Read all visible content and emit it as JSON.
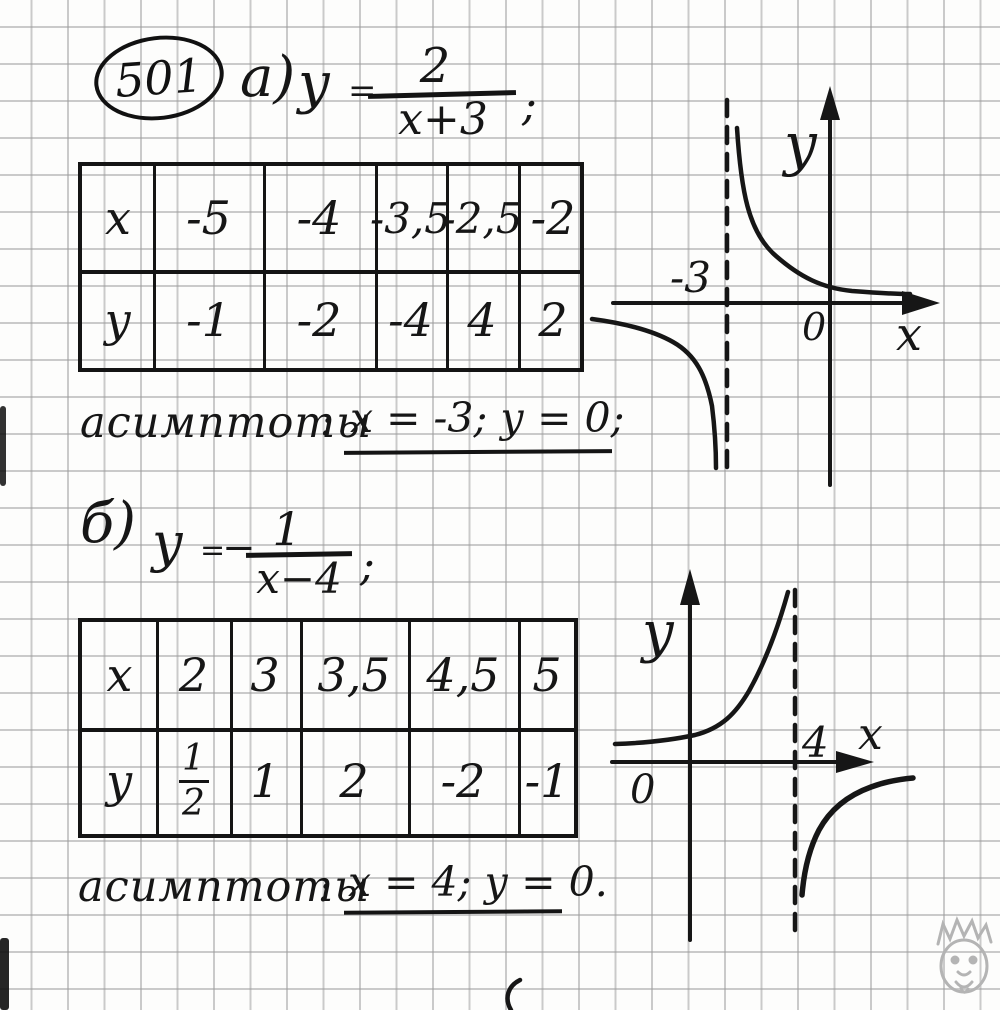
{
  "palette": {
    "ink": "#161616",
    "paper": "#fdfdfc",
    "grid_line": "#9c9c9c",
    "watermark": "#b4b4b4"
  },
  "problem": {
    "number": "501",
    "part_a": {
      "label": "а)",
      "formula": {
        "lhs": "у",
        "equals": "=",
        "numerator": "2",
        "denominator": "х+3",
        "terminator": ";"
      },
      "table": {
        "x_header": "х",
        "x_values": [
          "-5",
          "-4",
          "-3,5",
          "-2,5",
          "-2"
        ],
        "y_header": "у",
        "y_values": [
          "-1",
          "-2",
          "-4",
          "4",
          "2"
        ]
      },
      "asymptotes": {
        "label": "асимптоты",
        "colon": ":",
        "value": "х = -3; у = 0;"
      },
      "graph": {
        "y_axis_label": "у",
        "x_axis_label": "х",
        "origin_label": "0",
        "asymptote_tick_label": "-3"
      }
    },
    "part_b": {
      "label": "б)",
      "formula": {
        "lhs": "у",
        "equals": "=",
        "minus": "−",
        "numerator": "1",
        "denominator": "х−4",
        "terminator": ";"
      },
      "table": {
        "x_header": "х",
        "x_values": [
          "2",
          "3",
          "3,5",
          "4,5",
          "5"
        ],
        "y_header": "у",
        "y_fraction": {
          "numerator": "1",
          "denominator": "2"
        },
        "y_values": [
          "1",
          "2",
          "-2",
          "-1"
        ]
      },
      "asymptotes": {
        "label": "асимптоты",
        "colon": ":",
        "value": "х = 4; у = 0."
      },
      "graph": {
        "y_axis_label": "у",
        "x_axis_label": "х",
        "origin_label": "0",
        "asymptote_tick_label": "4"
      }
    }
  },
  "chart_data": [
    {
      "type": "line",
      "subtype": "hyperbola-sketch",
      "title": "у = 2/(х+3)",
      "x": [
        -5,
        -4,
        -3.5,
        -2.5,
        -2
      ],
      "y": [
        -1,
        -2,
        -4,
        4,
        2
      ],
      "asymptotes": {
        "vertical_x": -3,
        "horizontal_y": 0
      },
      "xlabel": "х",
      "ylabel": "у",
      "origin_label": "0",
      "annotations": [
        "-3"
      ],
      "grid": true,
      "branches": [
        "upper branch right of x=-3 decreasing toward y=0",
        "lower branch left of x=-3 falling to -infinity"
      ]
    },
    {
      "type": "line",
      "subtype": "hyperbola-sketch",
      "title": "у = −1/(х−4)",
      "x": [
        2,
        3,
        3.5,
        4.5,
        5
      ],
      "y": [
        0.5,
        1,
        2,
        -2,
        -1
      ],
      "asymptotes": {
        "vertical_x": 4,
        "horizontal_y": 0
      },
      "xlabel": "х",
      "ylabel": "у",
      "origin_label": "0",
      "annotations": [
        "4"
      ],
      "grid": true,
      "branches": [
        "left branch above y=0 rising to +infinity at x=4",
        "right branch below y=0 rising toward y=0"
      ]
    }
  ]
}
